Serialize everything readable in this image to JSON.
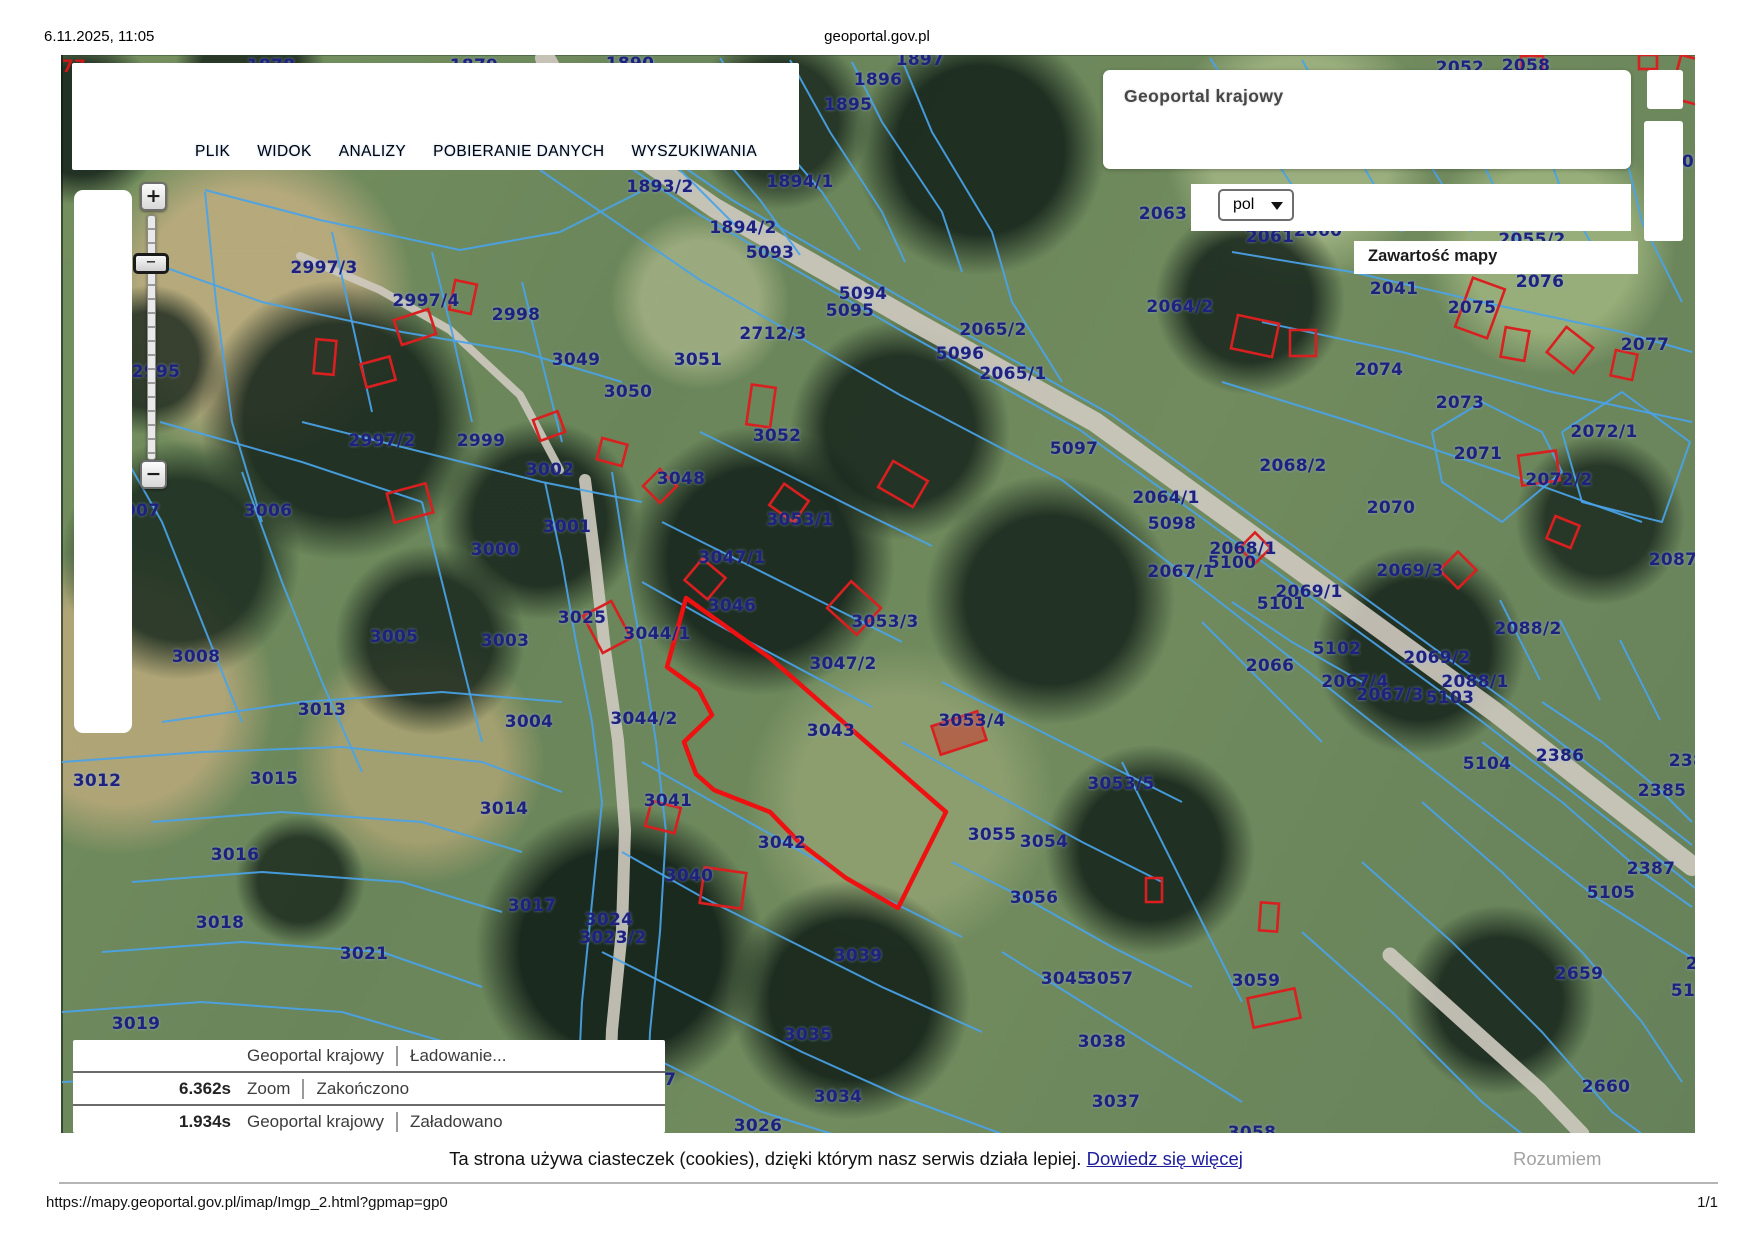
{
  "page": {
    "printed_date": "6.11.2025, 11:05",
    "printed_title": "geoportal.gov.pl",
    "footer_url": "https://mapy.geoportal.gov.pl/imap/Imgp_2.html?gpmap=gp0",
    "page_indicator": "1/1"
  },
  "menu": {
    "items": [
      "PLIK",
      "WIDOK",
      "ANALIZY",
      "POBIERANIE DANYCH",
      "WYSZUKIWANIA"
    ]
  },
  "header_panel": {
    "app_title": "Geoportal krajowy",
    "language_value": "pol",
    "map_content_label": "Zawartość mapy"
  },
  "zoom_control": {
    "zoom_in": "+",
    "zoom_out": "−",
    "handle": "−"
  },
  "loading_panel": {
    "rows": [
      {
        "time": "",
        "source": "Geoportal krajowy",
        "status": "Ładowanie..."
      },
      {
        "time": "6.362s",
        "source": "Zoom",
        "status": "Zakończono"
      },
      {
        "time": "1.934s",
        "source": "Geoportal krajowy",
        "status": "Załadowano"
      }
    ]
  },
  "cookie_banner": {
    "message": "Ta strona używa ciasteczek (cookies), dzięki którym nasz serwis działa lepiej.",
    "link_label": "Dowiedz się więcej",
    "accept_label": "Rozumiem"
  },
  "colors": {
    "parcel_label": "#20207f",
    "boundary_line": "#4aa3e8",
    "building_outline": "#d91f1f",
    "highlight_outline": "#ee1111",
    "road_fill": "#cfcac0"
  },
  "map": {
    "labels": [
      {
        "t": "1878",
        "x": 271,
        "y": 66
      },
      {
        "t": "1879",
        "x": 474,
        "y": 66
      },
      {
        "t": "1890",
        "x": 630,
        "y": 64
      },
      {
        "t": "77",
        "x": 74,
        "y": 67,
        "c": "red"
      },
      {
        "t": "1896",
        "x": 878,
        "y": 80
      },
      {
        "t": "1897",
        "x": 920,
        "y": 60
      },
      {
        "t": "1895",
        "x": 848,
        "y": 105
      },
      {
        "t": "2052",
        "x": 1460,
        "y": 68
      },
      {
        "t": "2058",
        "x": 1526,
        "y": 66
      },
      {
        "t": "2997/3",
        "x": 324,
        "y": 268
      },
      {
        "t": "2997/4",
        "x": 426,
        "y": 301
      },
      {
        "t": "2998",
        "x": 516,
        "y": 315
      },
      {
        "t": "2995",
        "x": 156,
        "y": 372
      },
      {
        "t": "3049",
        "x": 576,
        "y": 360
      },
      {
        "t": "3050",
        "x": 628,
        "y": 392
      },
      {
        "t": "3051",
        "x": 698,
        "y": 360
      },
      {
        "t": "2712/3",
        "x": 773,
        "y": 334
      },
      {
        "t": "1893/2",
        "x": 660,
        "y": 187
      },
      {
        "t": "1894/1",
        "x": 800,
        "y": 182
      },
      {
        "t": "1894/2",
        "x": 743,
        "y": 228
      },
      {
        "t": "5093",
        "x": 770,
        "y": 253
      },
      {
        "t": "5094",
        "x": 863,
        "y": 294
      },
      {
        "t": "5095",
        "x": 850,
        "y": 311
      },
      {
        "t": "2063",
        "x": 1163,
        "y": 214
      },
      {
        "t": "2061",
        "x": 1270,
        "y": 237
      },
      {
        "t": "2060",
        "x": 1318,
        "y": 231
      },
      {
        "t": "2055/2",
        "x": 1532,
        "y": 240
      },
      {
        "t": "01",
        "x": 1694,
        "y": 162
      },
      {
        "t": "2041",
        "x": 1394,
        "y": 289
      },
      {
        "t": "2076",
        "x": 1540,
        "y": 282
      },
      {
        "t": "2075",
        "x": 1472,
        "y": 308
      },
      {
        "t": "2074",
        "x": 1379,
        "y": 370
      },
      {
        "t": "2077",
        "x": 1645,
        "y": 345
      },
      {
        "t": "2064/2",
        "x": 1180,
        "y": 307
      },
      {
        "t": "2065/2",
        "x": 993,
        "y": 330
      },
      {
        "t": "5096",
        "x": 960,
        "y": 354
      },
      {
        "t": "2065/1",
        "x": 1013,
        "y": 374
      },
      {
        "t": "2997/2",
        "x": 382,
        "y": 441
      },
      {
        "t": "2999",
        "x": 481,
        "y": 441
      },
      {
        "t": "3002",
        "x": 550,
        "y": 470
      },
      {
        "t": "3001",
        "x": 567,
        "y": 527
      },
      {
        "t": "3000",
        "x": 495,
        "y": 550
      },
      {
        "t": "3006",
        "x": 268,
        "y": 511
      },
      {
        "t": "3007",
        "x": 136,
        "y": 511
      },
      {
        "t": "3048",
        "x": 681,
        "y": 479
      },
      {
        "t": "3052",
        "x": 777,
        "y": 436
      },
      {
        "t": "3053/1",
        "x": 800,
        "y": 520
      },
      {
        "t": "3047/1",
        "x": 732,
        "y": 558
      },
      {
        "t": "3046",
        "x": 732,
        "y": 606
      },
      {
        "t": "3044/1",
        "x": 657,
        "y": 634
      },
      {
        "t": "3053/3",
        "x": 885,
        "y": 622
      },
      {
        "t": "3047/2",
        "x": 843,
        "y": 664
      },
      {
        "t": "3025",
        "x": 582,
        "y": 618
      },
      {
        "t": "3005",
        "x": 394,
        "y": 637
      },
      {
        "t": "3003",
        "x": 505,
        "y": 641
      },
      {
        "t": "3008",
        "x": 196,
        "y": 657
      },
      {
        "t": "5097",
        "x": 1074,
        "y": 449
      },
      {
        "t": "2064/1",
        "x": 1166,
        "y": 498
      },
      {
        "t": "5098",
        "x": 1172,
        "y": 524
      },
      {
        "t": "2067/1",
        "x": 1181,
        "y": 572
      },
      {
        "t": "2068/1",
        "x": 1243,
        "y": 549
      },
      {
        "t": "5100",
        "x": 1232,
        "y": 563
      },
      {
        "t": "2068/2",
        "x": 1293,
        "y": 466
      },
      {
        "t": "2070",
        "x": 1391,
        "y": 508
      },
      {
        "t": "2071",
        "x": 1478,
        "y": 454
      },
      {
        "t": "2073",
        "x": 1460,
        "y": 403
      },
      {
        "t": "2072/1",
        "x": 1604,
        "y": 432
      },
      {
        "t": "2072/2",
        "x": 1559,
        "y": 480
      },
      {
        "t": "2069/3",
        "x": 1410,
        "y": 571
      },
      {
        "t": "2069/1",
        "x": 1309,
        "y": 592
      },
      {
        "t": "5101",
        "x": 1281,
        "y": 604
      },
      {
        "t": "2087",
        "x": 1673,
        "y": 560
      },
      {
        "t": "2088/2",
        "x": 1528,
        "y": 629
      },
      {
        "t": "5102",
        "x": 1337,
        "y": 649
      },
      {
        "t": "2069/2",
        "x": 1437,
        "y": 658
      },
      {
        "t": "2066",
        "x": 1270,
        "y": 666
      },
      {
        "t": "2067/4",
        "x": 1355,
        "y": 682
      },
      {
        "t": "2088/1",
        "x": 1475,
        "y": 682
      },
      {
        "t": "2067/3",
        "x": 1390,
        "y": 695
      },
      {
        "t": "5103",
        "x": 1450,
        "y": 698
      },
      {
        "t": "3013",
        "x": 322,
        "y": 710
      },
      {
        "t": "3012",
        "x": 97,
        "y": 781
      },
      {
        "t": "3015",
        "x": 274,
        "y": 779
      },
      {
        "t": "3004",
        "x": 529,
        "y": 722
      },
      {
        "t": "3044/2",
        "x": 644,
        "y": 719
      },
      {
        "t": "3014",
        "x": 504,
        "y": 809
      },
      {
        "t": "3016",
        "x": 235,
        "y": 855
      },
      {
        "t": "3017",
        "x": 532,
        "y": 906
      },
      {
        "t": "3024",
        "x": 609,
        "y": 920
      },
      {
        "t": "3023/2",
        "x": 613,
        "y": 938
      },
      {
        "t": "3018",
        "x": 220,
        "y": 923
      },
      {
        "t": "3021",
        "x": 364,
        "y": 954
      },
      {
        "t": "3019",
        "x": 136,
        "y": 1024
      },
      {
        "t": "3043",
        "x": 831,
        "y": 731
      },
      {
        "t": "3042",
        "x": 782,
        "y": 843
      },
      {
        "t": "3041",
        "x": 668,
        "y": 801
      },
      {
        "t": "3040",
        "x": 689,
        "y": 876
      },
      {
        "t": "3039",
        "x": 858,
        "y": 956
      },
      {
        "t": "3035",
        "x": 808,
        "y": 1035
      },
      {
        "t": "3034",
        "x": 838,
        "y": 1097
      },
      {
        "t": "3026",
        "x": 758,
        "y": 1126
      },
      {
        "t": "3027",
        "x": 652,
        "y": 1080
      },
      {
        "t": "3053/4",
        "x": 972,
        "y": 721
      },
      {
        "t": "3053/5",
        "x": 1121,
        "y": 784
      },
      {
        "t": "3055",
        "x": 992,
        "y": 835
      },
      {
        "t": "3054",
        "x": 1044,
        "y": 842
      },
      {
        "t": "3056",
        "x": 1034,
        "y": 898
      },
      {
        "t": "3045",
        "x": 1065,
        "y": 979
      },
      {
        "t": "3057",
        "x": 1109,
        "y": 979
      },
      {
        "t": "3038",
        "x": 1102,
        "y": 1042
      },
      {
        "t": "3037",
        "x": 1116,
        "y": 1102
      },
      {
        "t": "3058",
        "x": 1252,
        "y": 1133
      },
      {
        "t": "3059",
        "x": 1256,
        "y": 981
      },
      {
        "t": "5104",
        "x": 1487,
        "y": 764
      },
      {
        "t": "2386",
        "x": 1560,
        "y": 756
      },
      {
        "t": "238",
        "x": 1687,
        "y": 761
      },
      {
        "t": "2385",
        "x": 1662,
        "y": 791
      },
      {
        "t": "2387",
        "x": 1651,
        "y": 869
      },
      {
        "t": "5105",
        "x": 1611,
        "y": 893
      },
      {
        "t": "2659",
        "x": 1579,
        "y": 974
      },
      {
        "t": "2",
        "x": 1692,
        "y": 964
      },
      {
        "t": "51",
        "x": 1683,
        "y": 991
      },
      {
        "t": "2660",
        "x": 1606,
        "y": 1087
      }
    ],
    "red_parcel": "686,598 770,658 946,812 898,908 846,878 800,843 770,812 714,790 696,774 684,742 712,715 699,690 667,667",
    "buildings": [
      [
        463,
        297,
        22,
        30,
        12
      ],
      [
        415,
        327,
        36,
        26,
        -18
      ],
      [
        378,
        372,
        30,
        24,
        -15
      ],
      [
        325,
        357,
        20,
        34,
        5
      ],
      [
        549,
        426,
        26,
        22,
        -20
      ],
      [
        612,
        452,
        26,
        22,
        15
      ],
      [
        660,
        486,
        24,
        24,
        45
      ],
      [
        761,
        406,
        24,
        40,
        8
      ],
      [
        789,
        503,
        30,
        26,
        35
      ],
      [
        903,
        484,
        40,
        30,
        30
      ],
      [
        705,
        579,
        30,
        28,
        40
      ],
      [
        854,
        608,
        40,
        36,
        42
      ],
      [
        410,
        503,
        40,
        30,
        -15
      ],
      [
        607,
        627,
        32,
        42,
        -28
      ],
      [
        1255,
        336,
        42,
        34,
        12
      ],
      [
        1303,
        343,
        26,
        26,
        0
      ],
      [
        1480,
        308,
        34,
        52,
        20
      ],
      [
        1515,
        344,
        24,
        30,
        10
      ],
      [
        1570,
        350,
        34,
        32,
        38
      ],
      [
        1624,
        365,
        22,
        26,
        12
      ],
      [
        1648,
        62,
        18,
        14,
        0
      ],
      [
        1690,
        80,
        30,
        44,
        15
      ],
      [
        1532,
        64,
        22,
        16,
        0
      ],
      [
        1539,
        468,
        38,
        30,
        -8
      ],
      [
        1563,
        532,
        26,
        24,
        22
      ],
      [
        1458,
        570,
        26,
        26,
        45
      ],
      [
        1255,
        548,
        22,
        22,
        45
      ],
      [
        959,
        733,
        48,
        30,
        -18,
        1
      ],
      [
        663,
        817,
        30,
        26,
        14
      ],
      [
        723,
        888,
        42,
        36,
        8
      ],
      [
        1154,
        890,
        16,
        24,
        0
      ],
      [
        1269,
        917,
        18,
        28,
        4
      ],
      [
        1274,
        1008,
        48,
        30,
        -12
      ]
    ],
    "roads": [
      {
        "p": "545,58 575,112 715,208 915,322 1095,422 1275,552 1495,712 1692,866",
        "w": 20
      },
      {
        "p": "585,480 595,560 605,650 618,740 625,830 622,930 612,1030 608,1134",
        "w": 12
      },
      {
        "p": "1390,955 1462,1020 1540,1090 1582,1134",
        "w": 15
      },
      {
        "p": "300,256 380,290 450,330 520,395 560,470",
        "w": 8
      }
    ],
    "boundaries": [
      "650,58 700,130 760,200 800,255",
      "720,58 762,122 822,192 860,250",
      "790,60 830,132 882,212 905,262",
      "852,62 882,122 942,212 962,272",
      "902,60 932,132 992,232 1012,302 1062,382",
      "612,100 682,172 742,232",
      "560,120 700,215 900,330 1080,430 1260,560 1480,720 1660,860 1695,888",
      "592,104 732,200 932,315 1112,415 1292,545 1512,705 1692,845",
      "540,170 700,280 900,395 1062,480 1230,610 1420,760 1600,900 1692,958",
      "1210,58 1262,140 1322,230",
      "1302,60 1342,130 1402,232",
      "1382,70 1422,152 1472,232",
      "1452,100 1492,182 1522,252",
      "1532,110 1562,192 1602,262",
      "1622,140 1642,222 1682,302",
      "1232,252 1352,272 1482,302 1622,332 1692,352",
      "1262,322 1402,352 1552,392 1692,422",
      "1222,382 1352,422 1502,472 1642,522",
      "1432,432 1482,402 1542,432 1562,472 1502,522 1442,482 1432,432",
      "1562,432 1622,392 1690,442 1662,522 1582,502 1562,432",
      "205,190 320,220 460,250 560,232 640,192",
      "150,262 262,302 402,332 522,352 622,382",
      "205,192 216,302 232,422 262,522",
      "332,232 352,322 372,412",
      "432,252 452,332 472,422",
      "522,282 542,362 562,442",
      "302,422 422,452 542,482 642,502",
      "160,422 302,462 422,502",
      "105,422 162,522 202,622 242,722",
      "242,472 282,582 322,682 362,772",
      "422,502 442,582 462,662 482,742",
      "545,482 562,562 576,642 592,722 602,802 592,902 582,1002 576,1132",
      "612,472 626,562 642,652 656,742 666,832 660,932 650,1032 646,1134",
      "700,432 782,472 862,512 932,546",
      "662,522 742,562 822,602 902,642",
      "642,582 722,627 802,670 872,707",
      "642,762 722,807 802,852 882,897 962,937",
      "622,852 702,897 792,942 882,987 982,1032",
      "602,952 702,1002 802,1052 902,1097 1002,1134",
      "662,1062 762,1112 832,1134",
      "162,722 302,702 442,692 562,702",
      "62,762 202,752 342,747 482,762 562,792",
      "152,822 282,812 422,822 522,852",
      "132,882 262,872 402,882 502,912",
      "102,952 242,942 382,952 482,987",
      "62,1012 202,1002 342,1012 462,1047",
      "62,1082 202,1077 352,1092 482,1132",
      "1542,702 1602,742 1662,792 1692,822",
      "1482,742 1562,802 1642,872 1692,907",
      "1422,802 1502,872 1582,952 1642,1022 1682,1082",
      "1362,862 1452,942 1542,1032 1612,1112 1642,1134",
      "1302,932 1392,1012 1482,1102 1522,1134",
      "942,682 1022,722 1102,762 1182,802",
      "902,742 992,792 1082,842 1162,882",
      "952,862 1032,902 1112,947 1192,987",
      "1002,952 1082,1002 1162,1052 1242,1102",
      "1122,762 1162,842 1202,922 1242,1002",
      "1232,602 1292,642 1362,682",
      "1202,622 1262,682 1322,742",
      "1560,620 1600,700",
      "1620,640 1660,720",
      "1500,600 1540,680"
    ]
  }
}
